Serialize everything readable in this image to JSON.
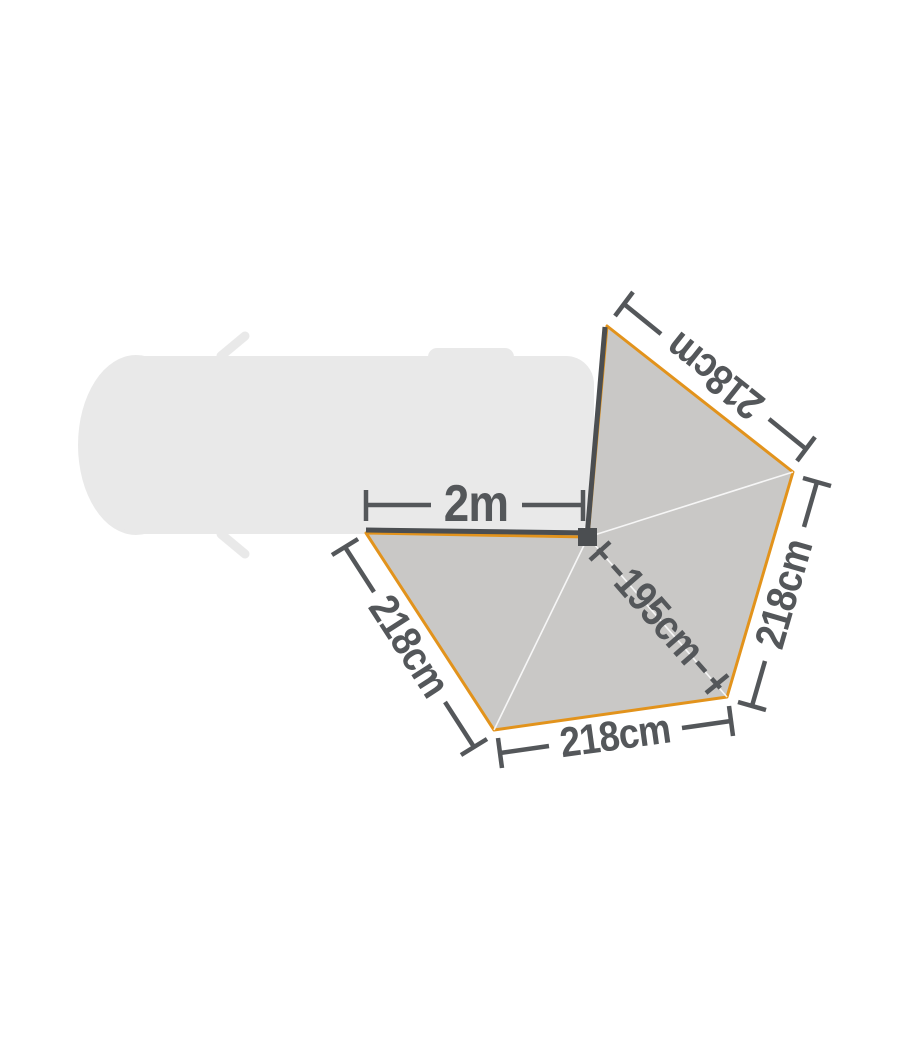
{
  "diagram": {
    "dimensions": {
      "mount_width": {
        "label": "2m"
      },
      "panel_top_edge": {
        "label": "218cm"
      },
      "panel_right_edge": {
        "label": "218cm"
      },
      "panel_bottom_edge": {
        "label": "218cm"
      },
      "panel_left_edge": {
        "label": "218cm"
      },
      "diagonal_radius": {
        "label": "195cm"
      }
    },
    "colors": {
      "background": "#ffffff",
      "vehicle-fill": "#e9e9e9",
      "canopy-fill": "#c9c8c6",
      "canopy-edge": "#e2931c",
      "frame-color": "#4b4e51",
      "seam-color": "#ffffff",
      "dimension-color": "#54575a"
    }
  }
}
